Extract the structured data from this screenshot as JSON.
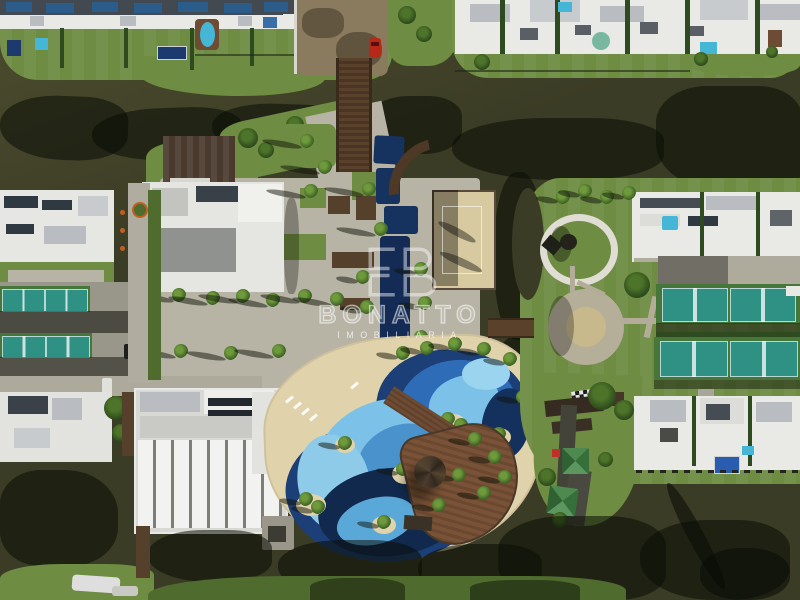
{
  "image": {
    "type": "aerial-drone-photograph",
    "subject": "waterfront gated community with canals, resort lagoon pool, tennis courts and townhouses"
  },
  "watermark": {
    "brand": "BONATTO",
    "tagline": "IMOBILIÁRIA",
    "logo": "split-b-monogram",
    "color": "#ffffff"
  },
  "palette": {
    "water": "#3b3c25",
    "waterLight": "#4c4c2e",
    "shadow": "rgba(10,12,6,0.55)",
    "grass": "#6e8c42",
    "grassDark": "#4f6b2e",
    "hedgeGreen": "#2e4a1f",
    "pavement": "#b7b3a5",
    "pavementDark": "#99968a",
    "street": "#adaa9c",
    "sand": "#e0d3ab",
    "sandCourt": "#d8caa0",
    "poolNavy": "#1d3f77",
    "poolDeep": "#12294e",
    "poolMid": "#2f6cb8",
    "poolLight": "#7cc1e8",
    "lapPool": "#16335f",
    "tealCourt": "#2f9184",
    "courtGreen": "#47763a",
    "wood": "#6e4b33",
    "woodDark": "#54402b",
    "bridge": "#5a412c",
    "roofDark": "#434950",
    "roofWhite": "#e9e9e6",
    "solar": "#2b5c8a",
    "redCar": "#b82818",
    "cyanPool": "#45b6d6",
    "dirtParking": "#8a7a5e"
  },
  "scene": {
    "regions": [
      "canal waterways",
      "solar-roof townhouses",
      "dirt parking lot",
      "amenity island plaza",
      "cascade lap pool",
      "resort lagoon pool",
      "sand volleyball court",
      "clubhouse",
      "glass-grid-roof building",
      "spiral lookout",
      "event plaza circle",
      "tennis courts",
      "playground with canopy tents",
      "giant chessboard",
      "wooden footbridge",
      "thatched hut",
      "pool deck peninsula"
    ]
  }
}
